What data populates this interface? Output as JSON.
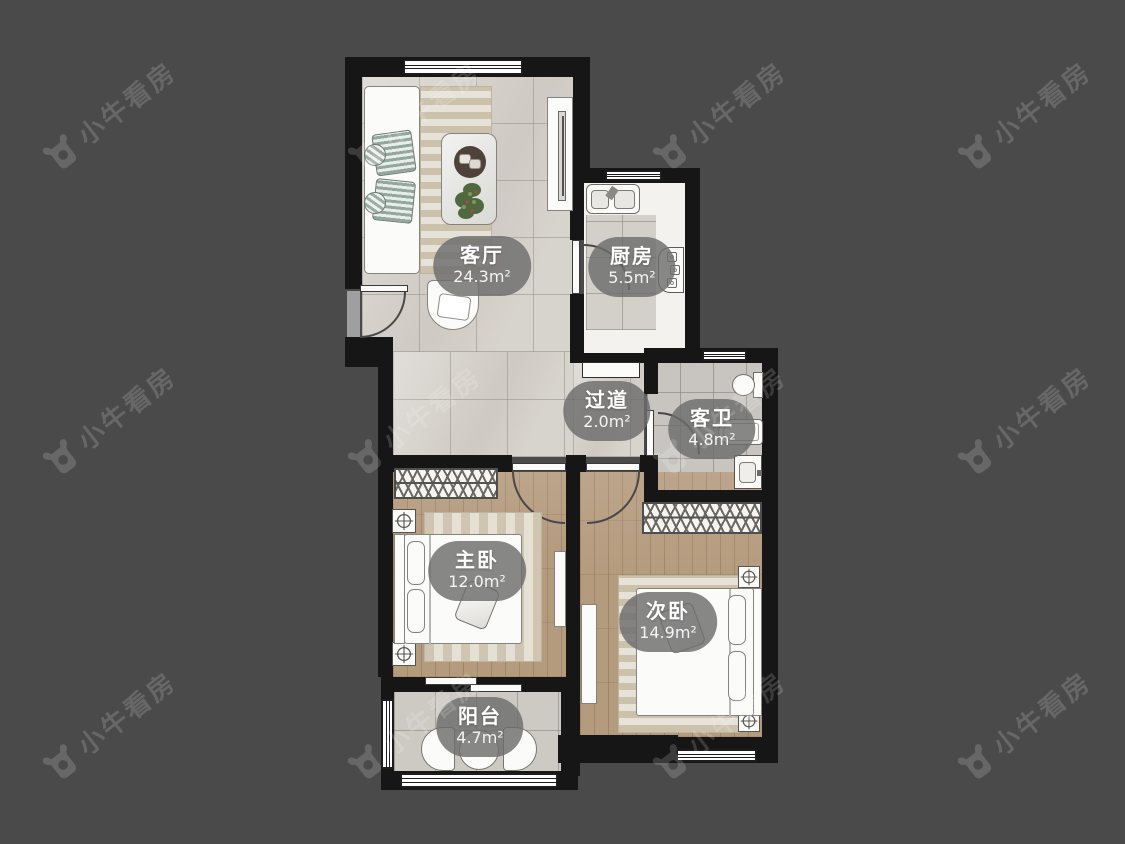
{
  "watermark": {
    "text": "小牛看房",
    "logo_icon": "bull-logo",
    "color": "#6c6c6e"
  },
  "palette": {
    "background": "#4a4a4b",
    "wall": "#161616",
    "tile_light": "#d7d3cd",
    "wood": "#b59b7e",
    "label_pill": "#6c6c6c"
  },
  "rooms": [
    {
      "id": "living",
      "name": "客厅",
      "area": "24.3m²"
    },
    {
      "id": "kitchen",
      "name": "厨房",
      "area": "5.5m²"
    },
    {
      "id": "hallway",
      "name": "过道",
      "area": "2.0m²"
    },
    {
      "id": "bathroom",
      "name": "客卫",
      "area": "4.8m²"
    },
    {
      "id": "master",
      "name": "主卧",
      "area": "12.0m²"
    },
    {
      "id": "second",
      "name": "次卧",
      "area": "14.9m²"
    },
    {
      "id": "balcony",
      "name": "阳台",
      "area": "4.7m²"
    }
  ]
}
